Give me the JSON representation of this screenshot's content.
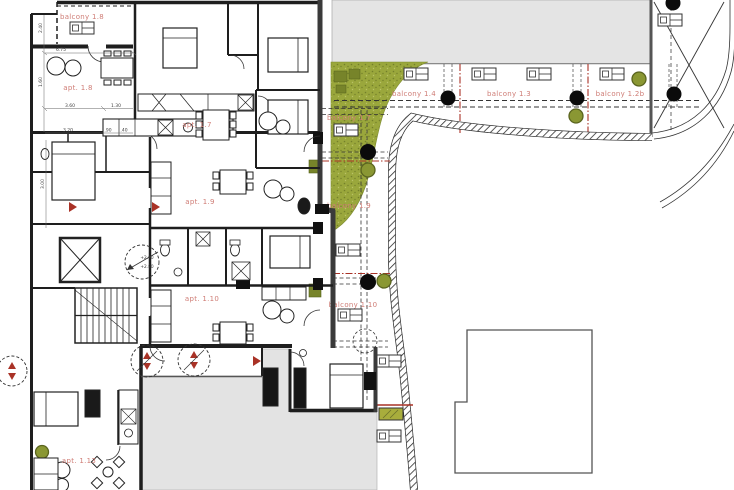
{
  "plan": {
    "apartments": {
      "a17": "apt. 1.7",
      "a18": "apt. 1.8",
      "a19": "apt. 1.9",
      "a110": "apt. 1.10",
      "a113": "apt. 1.13"
    },
    "balconies": {
      "b18": "balcony 1.8",
      "b14": "balcony 1.4",
      "b13": "balcony 1.3",
      "b12b": "balcony 1.2b",
      "b17": "balcony 1.7",
      "b19": "balcony 1.9",
      "b110": "balcony 1.10"
    },
    "level_marker": {
      "upper": "+2.90",
      "lower": "+2.80"
    },
    "dimensions": {
      "h1": "6.75",
      "h2": "3.60",
      "h3": "1.30",
      "h4": "3.20",
      "h5": ".90",
      "h6": ".40",
      "v1": "2.40",
      "v2": "1.60",
      "v3": "3.00"
    },
    "colors": {
      "label": "#cf7d76",
      "accent_red": "#a93226",
      "grass": "#9aa73c",
      "olive": "#7f8c2a",
      "paved_gray": "#e3e3e3",
      "wall": "#222222"
    }
  }
}
